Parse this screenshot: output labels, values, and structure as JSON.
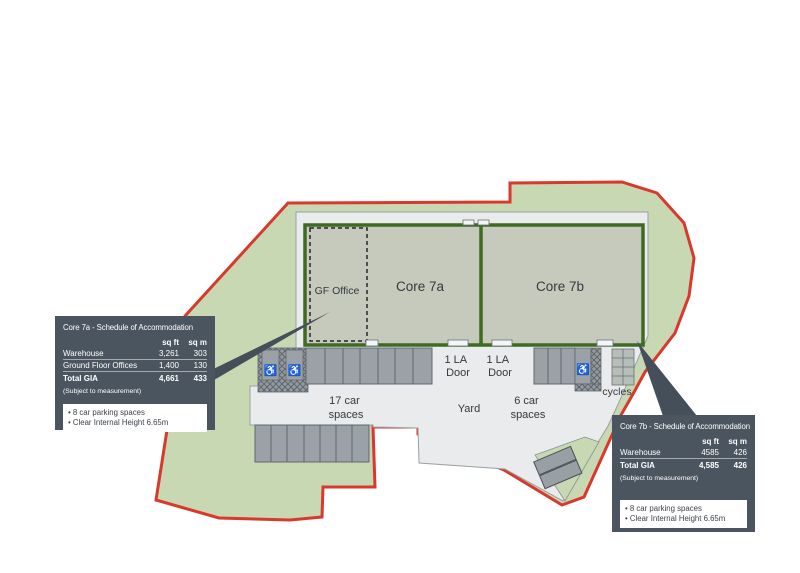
{
  "plan": {
    "gf_office": "GF Office",
    "core_7a": "Core 7a",
    "core_7b": "Core 7b",
    "la_door_a_line1": "1 LA",
    "la_door_a_line2": "Door",
    "la_door_b_line1": "1 LA",
    "la_door_b_line2": "Door",
    "parking_17_line1": "17 car",
    "parking_17_line2": "spaces",
    "yard": "Yard",
    "parking_6_line1": "6 car",
    "parking_6_line2": "spaces",
    "cycles": "cycles",
    "wheelchair_symbol": "♿"
  },
  "callout_7a": {
    "title": "Core 7a - Schedule of Accommodation",
    "col_sqft": "sq ft",
    "col_sqm": "sq m",
    "rows": [
      {
        "label": "Warehouse",
        "sqft": "3,261",
        "sqm": "303"
      },
      {
        "label": "Ground Floor Offices",
        "sqft": "1,400",
        "sqm": "130"
      }
    ],
    "total_label": "Total GIA",
    "total_sqft": "4,661",
    "total_sqm": "433",
    "note": "(Subject to measurement)",
    "bullets": [
      "• 8 car parking spaces",
      "• Clear Internal Height 6.65m"
    ]
  },
  "callout_7b": {
    "title": "Core 7b - Schedule of Accommodation",
    "col_sqft": "sq ft",
    "col_sqm": "sq m",
    "rows": [
      {
        "label": "Warehouse",
        "sqft": "4585",
        "sqm": "426"
      }
    ],
    "total_label": "Total GIA",
    "total_sqft": "4,585",
    "total_sqm": "426",
    "note": "(Subject to measurement)",
    "bullets": [
      "• 8 car parking spaces",
      "• Clear Internal Height 6.65m"
    ]
  },
  "colors": {
    "boundary_red": "#d8392c",
    "landscape_green": "#c8d8b2",
    "hardstanding_gray": "#e9ebec",
    "building_fill": "#c5cabd",
    "building_border_green": "#3f6b21",
    "panel_dark": "#4a5560",
    "parking_gray": "#9aa1a7"
  }
}
